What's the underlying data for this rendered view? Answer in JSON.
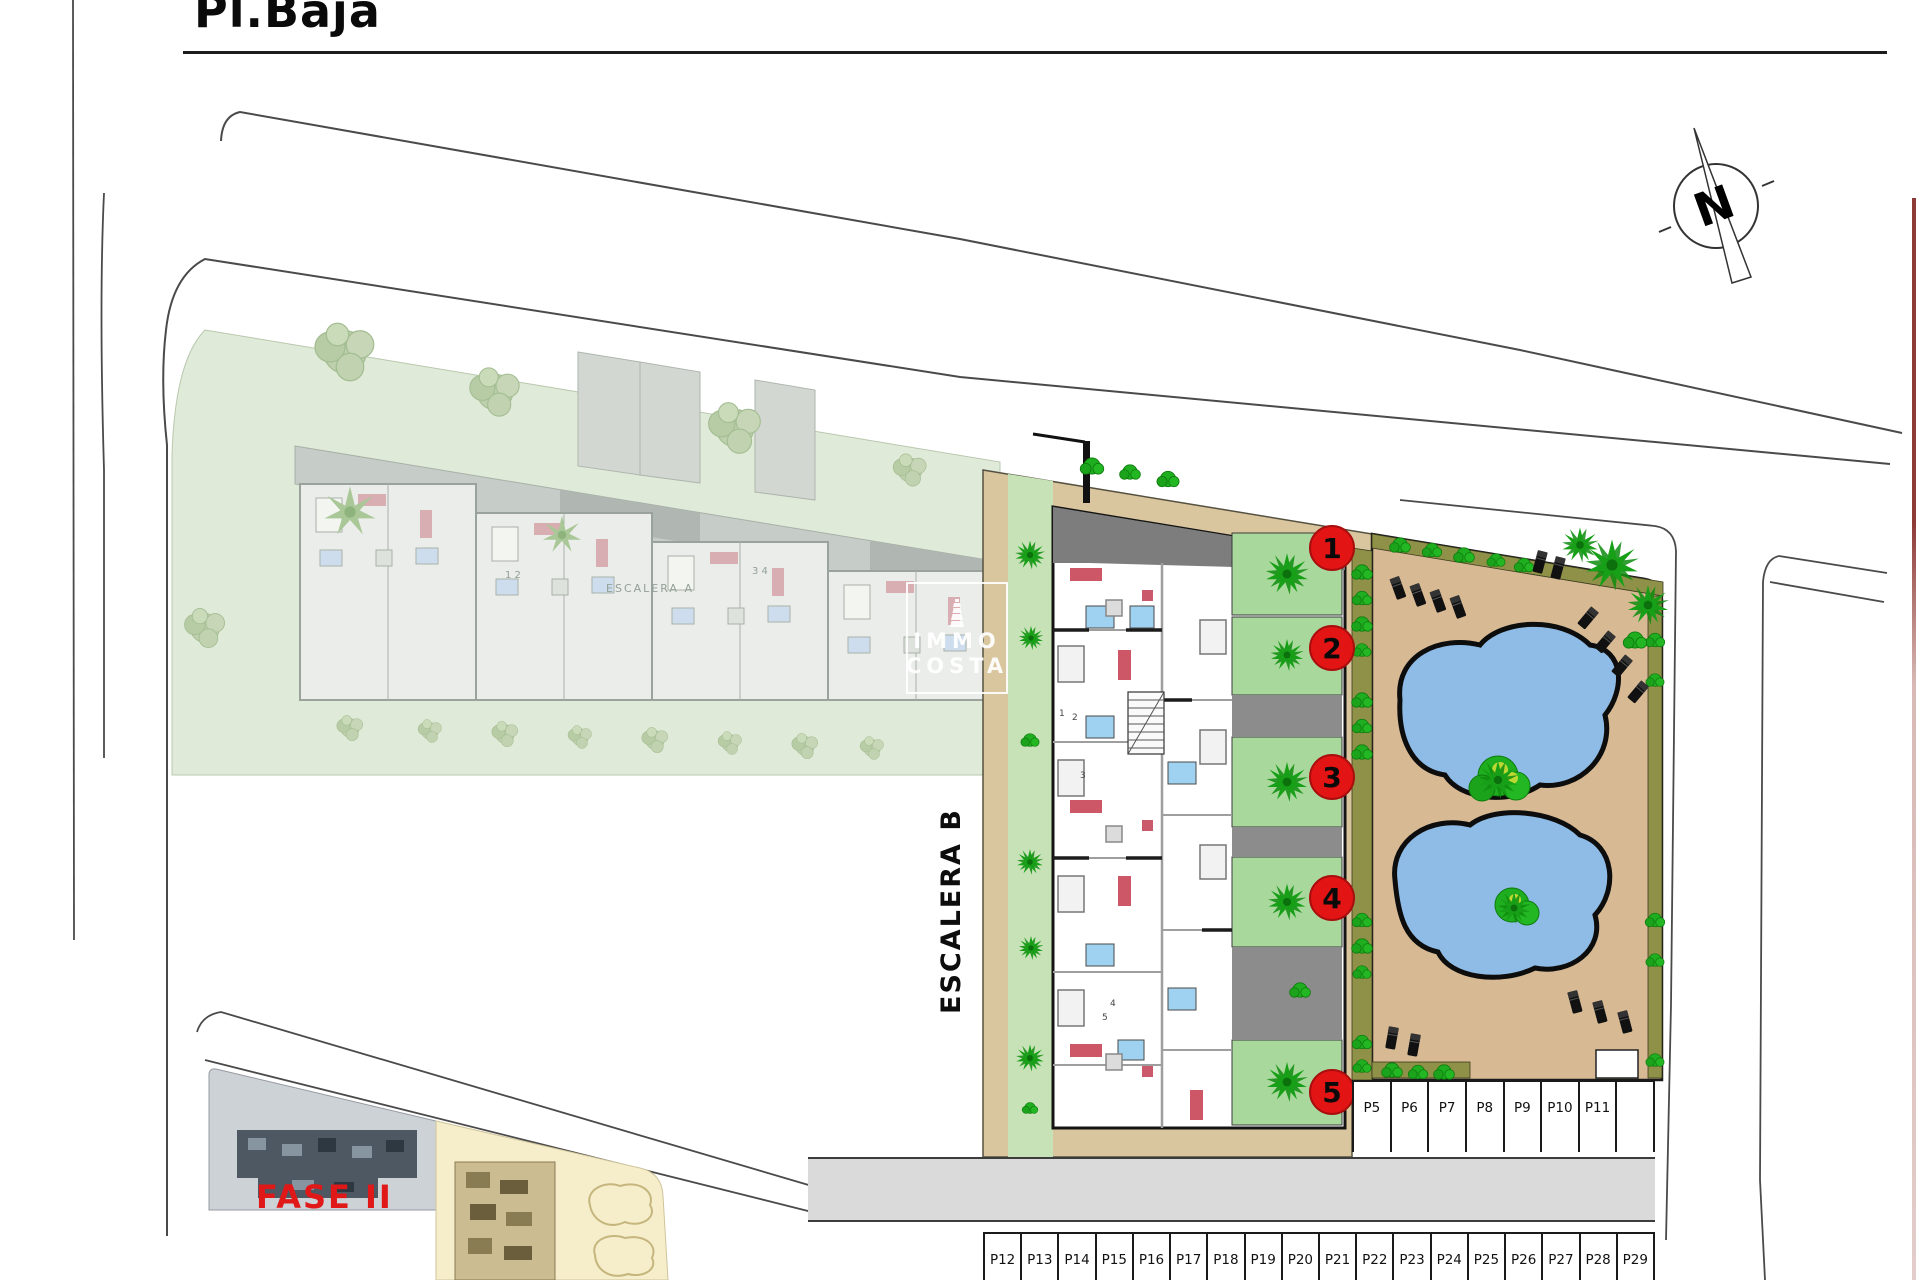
{
  "title": {
    "text": "Pl.Baja"
  },
  "compass": {
    "letter": "N"
  },
  "watermark": {
    "line1": "IMMO",
    "line2": "COSTA"
  },
  "site": {
    "escalera_b_label": "ESCALERA B",
    "phase2_label": "FASE II",
    "faded_building_label": "ESCALERA A",
    "faded_unit_digits_left": "1 2",
    "faded_unit_digits_right": "3 4",
    "interior_digits": [
      "1",
      "2",
      "3",
      "4",
      "5"
    ]
  },
  "unit_markers": [
    "1",
    "2",
    "3",
    "4",
    "5"
  ],
  "parking_right": [
    "P5",
    "P6",
    "P7",
    "P8",
    "P9",
    "P10",
    "P11",
    ""
  ],
  "parking_bottom": [
    "P12",
    "P13",
    "P14",
    "P15",
    "P16",
    "P17",
    "P18",
    "P19",
    "P20",
    "P21",
    "P22",
    "P23",
    "P24",
    "P25",
    "P26",
    "P27",
    "P28",
    "P29"
  ],
  "colors": {
    "marker-red": "#e21414",
    "label-red": "#e01818",
    "beige": "#d9c69e",
    "deck-tan": "#d7b993",
    "pool-blue": "#8fbce6",
    "garden-green": "#a9d89c",
    "strip-green": "#c6e2b6",
    "hedge-olive": "#8e9147",
    "palm-green": "#17a017",
    "faded-lawn": "#e0ead8",
    "roof-grey": "#7d7d7d",
    "road-grey": "#dadada",
    "inset-grey": "#ccd2d6",
    "inset-cream": "#f6eecb",
    "edge-red": "#8e3a36"
  }
}
